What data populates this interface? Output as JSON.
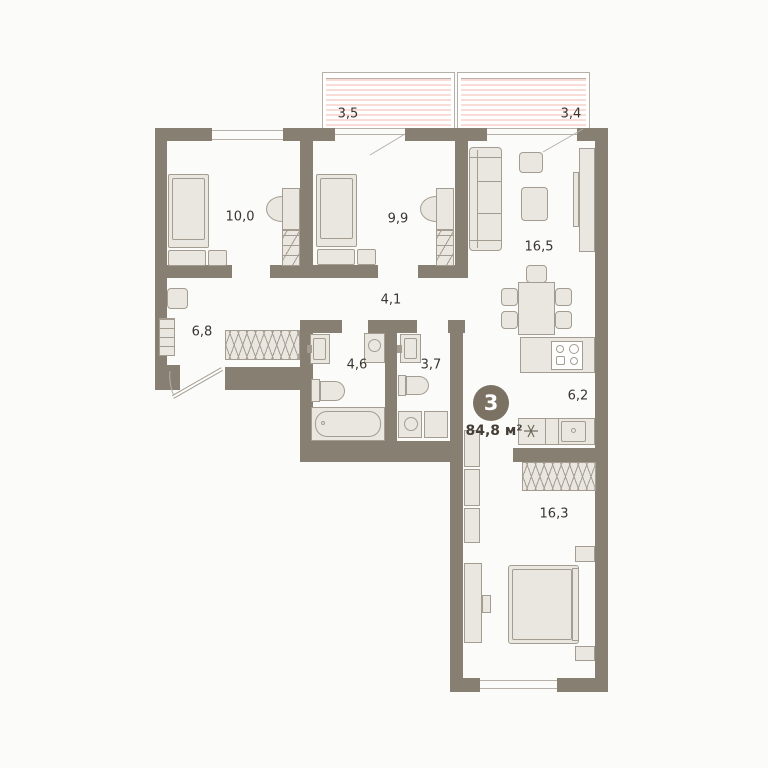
{
  "plan": {
    "badge_rooms_count": "3",
    "total_area": "84,8 м²",
    "rooms": {
      "balcony_left": {
        "area": "3,5"
      },
      "balcony_right": {
        "area": "3,4"
      },
      "bedroom_1": {
        "area": "10,0"
      },
      "bedroom_2": {
        "area": "9,9"
      },
      "living_room": {
        "area": "16,5"
      },
      "corridor": {
        "area": "4,1"
      },
      "hallway": {
        "area": "6,8"
      },
      "bathroom": {
        "area": "4,6"
      },
      "toilet": {
        "area": "3,7"
      },
      "kitchen": {
        "area": "6,2"
      },
      "bedroom_3": {
        "area": "16,3"
      }
    },
    "colors": {
      "wall": "#877f72",
      "ffill": "#eae7e1",
      "fstroke": "#a49c90",
      "line": "#b6b0a8",
      "stripe": "#f8dcd5",
      "badge": "#7b7264",
      "text": "#3a3530",
      "area_text": "#443e37",
      "bg": "#fbfbf9"
    }
  }
}
